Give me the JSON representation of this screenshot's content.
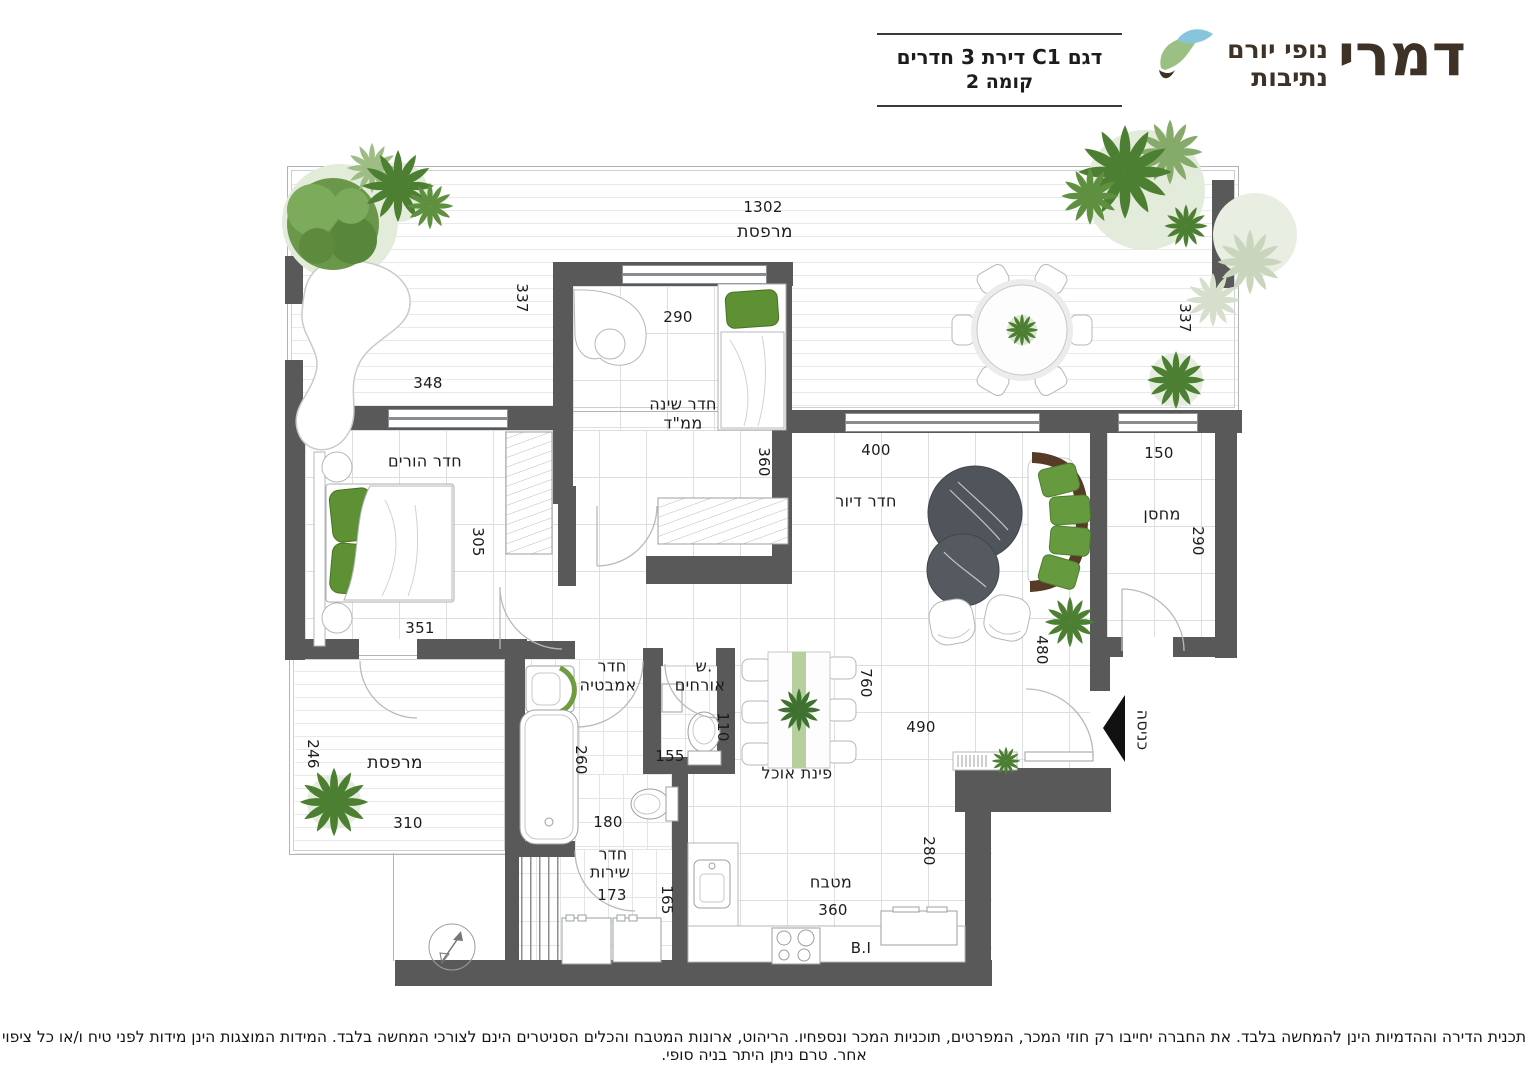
{
  "header": {
    "brand": "דמרי",
    "brand_sub_line1": "נופי יורם",
    "brand_sub_line2": "נתיבות",
    "title_line1": "דגם C1 דירת 3 חדרים",
    "title_line2": "קומה 2"
  },
  "rooms": {
    "balcony_top": "מרפסת",
    "mamad_line1": "חדר שינה",
    "mamad_line2": "ממ\"ד",
    "master_bedroom": "חדר הורים",
    "living_room": "חדר דיור",
    "storage": "מחסן",
    "bathroom_line1": "חדר",
    "bathroom_line2": "אמבטיה",
    "guest_wc_line1": "ש.",
    "guest_wc_line2": "אורחים",
    "dining": "פינת אוכל",
    "kitchen": "מטבח",
    "service_line1": "חדר",
    "service_line2": "שירות",
    "balcony_bottom": "מרפסת",
    "entrance": "כניסה"
  },
  "dimensions": {
    "balcony_top_w": "1302",
    "balcony_top_left_h": "337",
    "balcony_top_left_w": "348",
    "balcony_top_right_h": "337",
    "mamad_w": "290",
    "mamad_h": "360",
    "master_h": "305",
    "master_w": "351",
    "living_w": "400",
    "living_h": "480",
    "storage_w": "150",
    "storage_h": "290",
    "balcony_bottom_h": "246",
    "balcony_bottom_w": "310",
    "bath_h": "260",
    "guest_wc_h": "110",
    "guest_wc_w": "155",
    "hall_w": "180",
    "dining_h": "760",
    "dining_w": "490",
    "kitchen_h": "280",
    "kitchen_w": "360",
    "service_w": "173",
    "service_h": "165",
    "built_in": "B.I"
  },
  "footer": {
    "disclaimer": "תכנית הדירה וההדמיות הינן להמחשה בלבד. את החברה יחייבו רק חוזי המכר, המפרטים, תוכניות המכר ונספחיו. הריהוט, ארונות המטבח והכלים הסניטרים הינם לצורכי המחשה בלבד. המידות המוצגות הינן מידות לפני טיח ו/או כל ציפוי אחר. טרם ניתן היתר בניה סופי."
  },
  "colors": {
    "wall": "#595959",
    "plant_green": "#4d7f33",
    "pillow_green": "#5d9134",
    "logo_brown": "#3e3126",
    "logo_leaf_green": "#9cc083",
    "logo_leaf_blue": "#86c5dc"
  }
}
